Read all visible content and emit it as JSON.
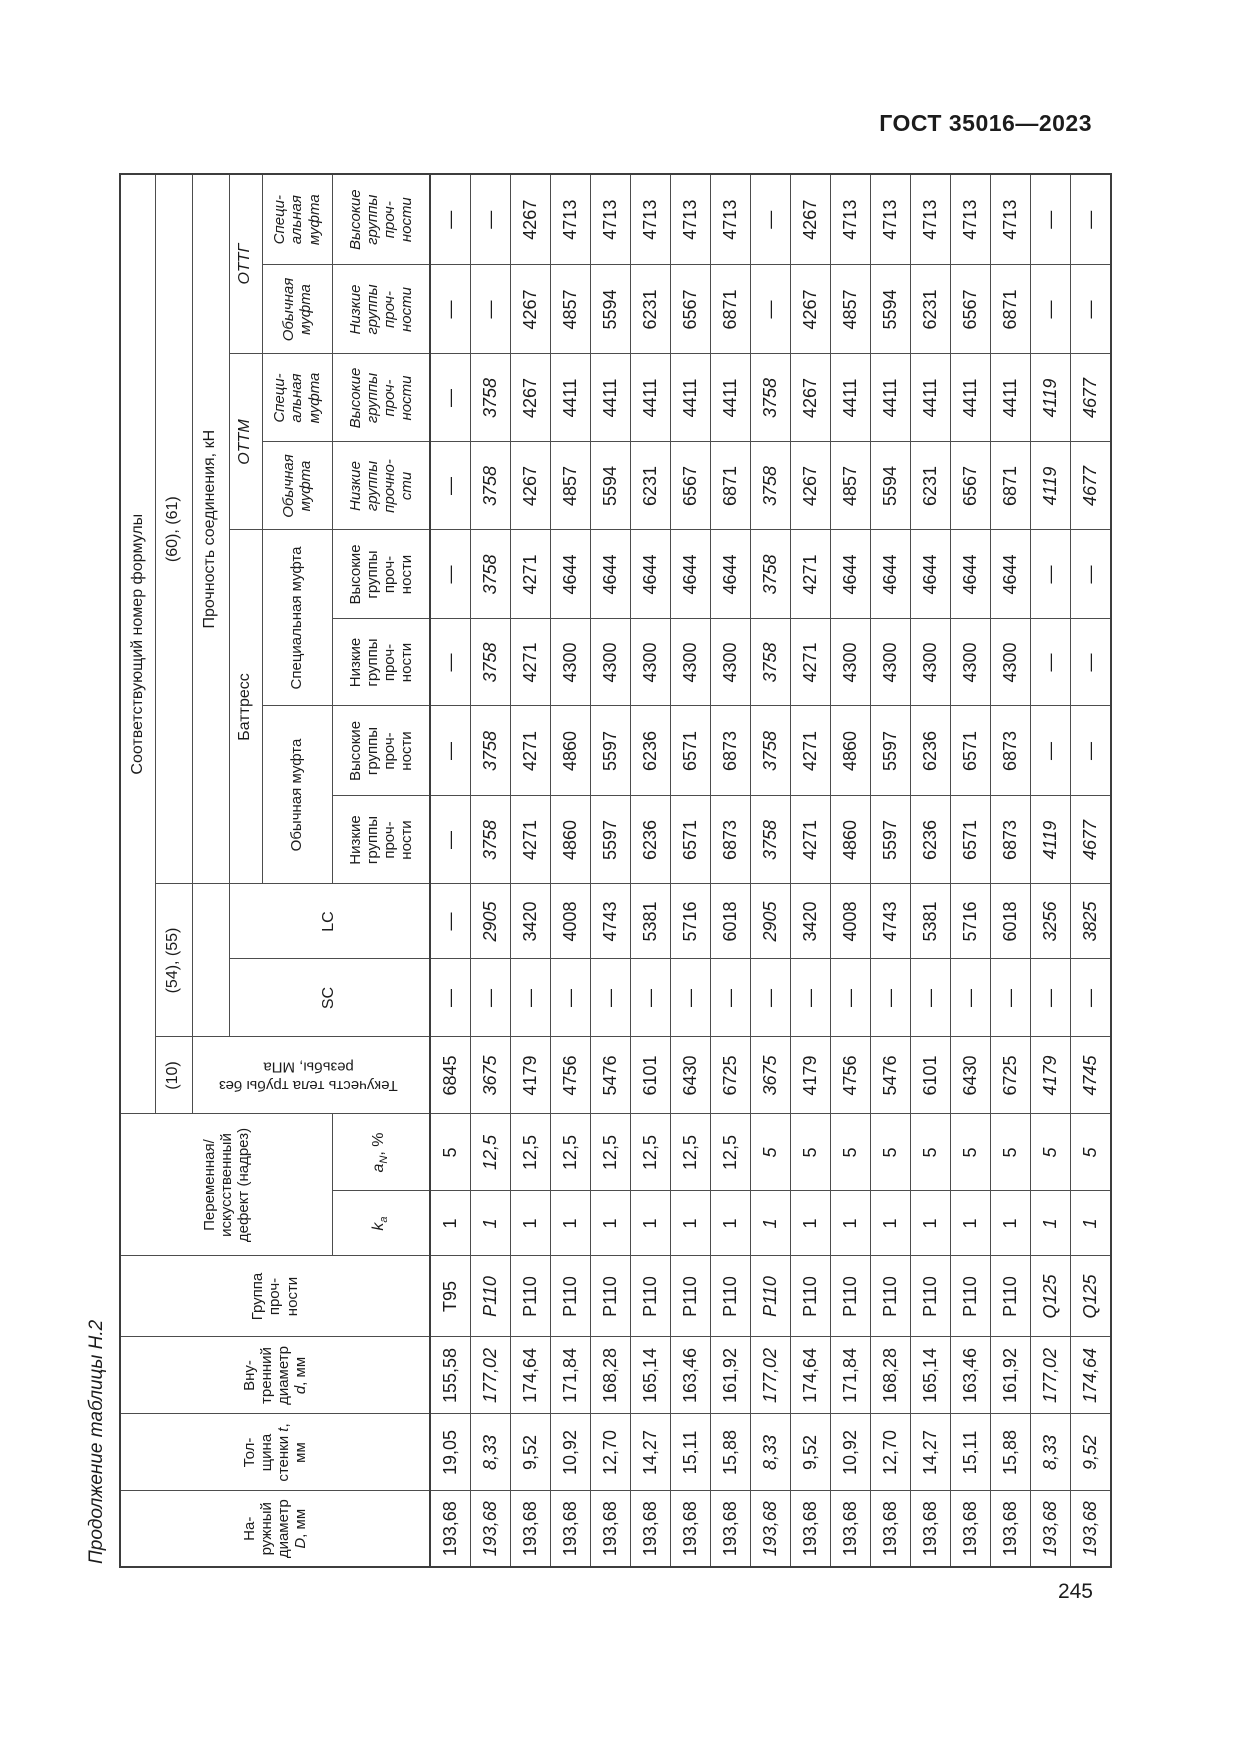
{
  "page": {
    "standard": "ГОСТ 35016—2023",
    "number": "245",
    "continuation": "Продолжение таблицы Н.2"
  },
  "header": {
    "outer_diameter": {
      "text": "На-\nружный\nдиаметр\n",
      "sym": "D",
      "unit": ", мм"
    },
    "wall_thickness": {
      "text": "Тол-\nщина\nстенки ",
      "sym": "t",
      "unit": ",\nмм"
    },
    "inner_diameter": {
      "text": "Вну-\nтренний\nдиаметр\n",
      "sym": "d",
      "unit": ", мм"
    },
    "strength_group": "Группа\nпроч-\nности",
    "defect": "Переменная/\nискусственный\nдефект (надрез)",
    "ka": {
      "sym": "k",
      "sub": "a"
    },
    "an": {
      "sym": "a",
      "sub": "N",
      "unit": ", %"
    },
    "formula_number": "Соответствующий номер формулы",
    "f10": "(10)",
    "f54_55": "(54), (55)",
    "f60_61": "(60), (61)",
    "yield_body": "Текучесть тела трубы без\nрезьбы, МПа",
    "sc": "SC",
    "lc": "LC",
    "joint_strength": "Прочность соединения, кН",
    "buttress": "Баттресс",
    "ottm": "ОТТМ",
    "ottg": "ОТТГ",
    "regular_coupling": "Обычная муфта",
    "special_coupling": "Специальная муфта",
    "regular_coupling_2l": "Обычная\nмуфта",
    "special_coupling_3l": "Специ-\nальная\nмуфта",
    "low_groups": "Низкие\nгруппы\nпроч-\nности",
    "high_groups": "Высокие\nгруппы\nпроч-\nности",
    "low_groups_alt": "Низкие\nгруппы\nпрочно-\nсти"
  },
  "columns_order": [
    "D",
    "t",
    "d",
    "группа",
    "ka",
    "aN",
    "текучесть",
    "SC",
    "LC",
    "Баттресс-обычная-низкие",
    "Баттресс-обычная-высокие",
    "Баттресс-специальная-низкие",
    "Баттресс-специальная-высокие",
    "ОТТМ-обычная-низкие",
    "ОТТМ-специальная-высокие",
    "ОТТГ-обычная-низкие",
    "ОТТГ-специальная-высокие"
  ],
  "rows": [
    {
      "i": false,
      "v": [
        "193,68",
        "19,05",
        "155,58",
        "Т95",
        "1",
        "5",
        "6845",
        "—",
        "—",
        "—",
        "—",
        "—",
        "—",
        "—",
        "—",
        "—",
        "—"
      ]
    },
    {
      "i": true,
      "v": [
        "193,68",
        "8,33",
        "177,02",
        "Р110",
        "1",
        "12,5",
        "3675",
        "—",
        "2905",
        "3758",
        "3758",
        "3758",
        "3758",
        "3758",
        "3758",
        "—",
        "—"
      ]
    },
    {
      "i": false,
      "v": [
        "193,68",
        "9,52",
        "174,64",
        "Р110",
        "1",
        "12,5",
        "4179",
        "—",
        "3420",
        "4271",
        "4271",
        "4271",
        "4271",
        "4267",
        "4267",
        "4267",
        "4267"
      ]
    },
    {
      "i": false,
      "v": [
        "193,68",
        "10,92",
        "171,84",
        "Р110",
        "1",
        "12,5",
        "4756",
        "—",
        "4008",
        "4860",
        "4860",
        "4300",
        "4644",
        "4857",
        "4411",
        "4857",
        "4713"
      ]
    },
    {
      "i": false,
      "v": [
        "193,68",
        "12,70",
        "168,28",
        "Р110",
        "1",
        "12,5",
        "5476",
        "—",
        "4743",
        "5597",
        "5597",
        "4300",
        "4644",
        "5594",
        "4411",
        "5594",
        "4713"
      ]
    },
    {
      "i": false,
      "v": [
        "193,68",
        "14,27",
        "165,14",
        "Р110",
        "1",
        "12,5",
        "6101",
        "—",
        "5381",
        "6236",
        "6236",
        "4300",
        "4644",
        "6231",
        "4411",
        "6231",
        "4713"
      ]
    },
    {
      "i": false,
      "v": [
        "193,68",
        "15,11",
        "163,46",
        "Р110",
        "1",
        "12,5",
        "6430",
        "—",
        "5716",
        "6571",
        "6571",
        "4300",
        "4644",
        "6567",
        "4411",
        "6567",
        "4713"
      ]
    },
    {
      "i": false,
      "v": [
        "193,68",
        "15,88",
        "161,92",
        "Р110",
        "1",
        "12,5",
        "6725",
        "—",
        "6018",
        "6873",
        "6873",
        "4300",
        "4644",
        "6871",
        "4411",
        "6871",
        "4713"
      ]
    },
    {
      "i": true,
      "v": [
        "193,68",
        "8,33",
        "177,02",
        "Р110",
        "1",
        "5",
        "3675",
        "—",
        "2905",
        "3758",
        "3758",
        "3758",
        "3758",
        "3758",
        "3758",
        "—",
        "—"
      ]
    },
    {
      "i": false,
      "v": [
        "193,68",
        "9,52",
        "174,64",
        "Р110",
        "1",
        "5",
        "4179",
        "—",
        "3420",
        "4271",
        "4271",
        "4271",
        "4271",
        "4267",
        "4267",
        "4267",
        "4267"
      ]
    },
    {
      "i": false,
      "v": [
        "193,68",
        "10,92",
        "171,84",
        "Р110",
        "1",
        "5",
        "4756",
        "—",
        "4008",
        "4860",
        "4860",
        "4300",
        "4644",
        "4857",
        "4411",
        "4857",
        "4713"
      ]
    },
    {
      "i": false,
      "v": [
        "193,68",
        "12,70",
        "168,28",
        "Р110",
        "1",
        "5",
        "5476",
        "—",
        "4743",
        "5597",
        "5597",
        "4300",
        "4644",
        "5594",
        "4411",
        "5594",
        "4713"
      ]
    },
    {
      "i": false,
      "v": [
        "193,68",
        "14,27",
        "165,14",
        "Р110",
        "1",
        "5",
        "6101",
        "—",
        "5381",
        "6236",
        "6236",
        "4300",
        "4644",
        "6231",
        "4411",
        "6231",
        "4713"
      ]
    },
    {
      "i": false,
      "v": [
        "193,68",
        "15,11",
        "163,46",
        "Р110",
        "1",
        "5",
        "6430",
        "—",
        "5716",
        "6571",
        "6571",
        "4300",
        "4644",
        "6567",
        "4411",
        "6567",
        "4713"
      ]
    },
    {
      "i": false,
      "v": [
        "193,68",
        "15,88",
        "161,92",
        "Р110",
        "1",
        "5",
        "6725",
        "—",
        "6018",
        "6873",
        "6873",
        "4300",
        "4644",
        "6871",
        "4411",
        "6871",
        "4713"
      ]
    },
    {
      "i": true,
      "v": [
        "193,68",
        "8,33",
        "177,02",
        "Q125",
        "1",
        "5",
        "4179",
        "—",
        "3256",
        "4119",
        "—",
        "—",
        "—",
        "4119",
        "4119",
        "—",
        "—"
      ]
    },
    {
      "i": true,
      "v": [
        "193,68",
        "9,52",
        "174,64",
        "Q125",
        "1",
        "5",
        "4745",
        "—",
        "3825",
        "4677",
        "—",
        "—",
        "—",
        "4677",
        "4677",
        "—",
        "—"
      ]
    }
  ]
}
